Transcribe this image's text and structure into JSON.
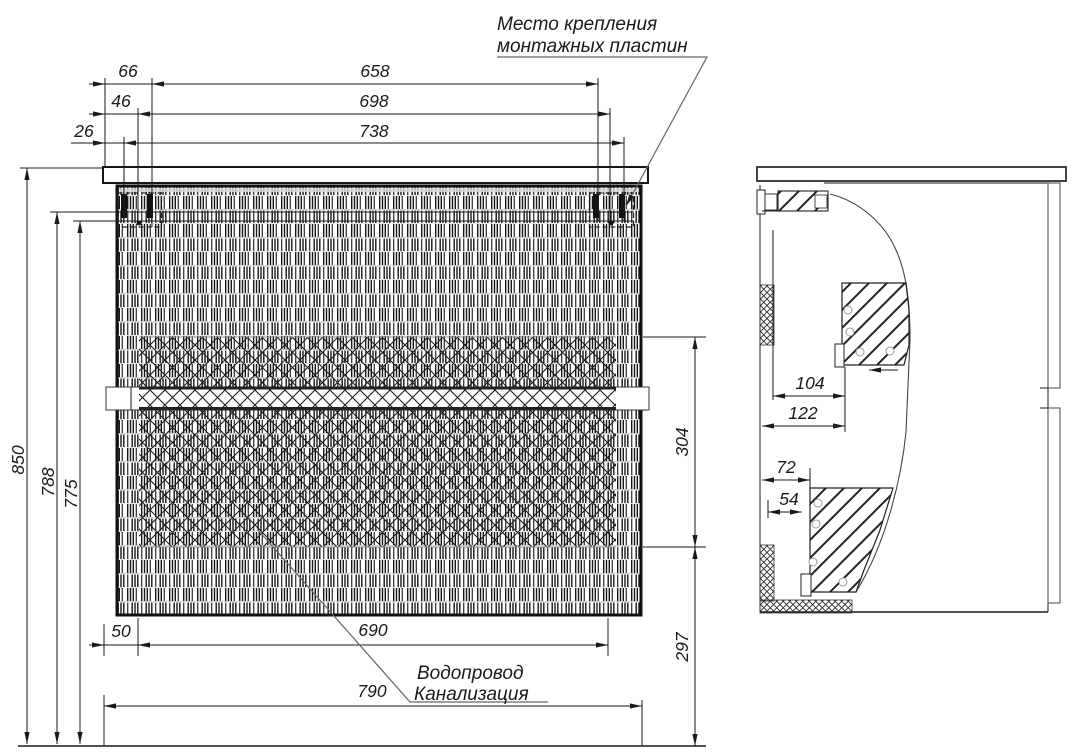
{
  "labels": {
    "mounting_plates_line1": "Место крепления",
    "mounting_plates_line2": "монтажных пластин",
    "plumbing_line1": "Водопровод",
    "plumbing_line2": "Канализация"
  },
  "dims": {
    "front_top_small_1": "66",
    "front_top_small_2": "46",
    "front_top_small_3": "26",
    "front_top_wide_1": "658",
    "front_top_wide_2": "698",
    "front_top_wide_3": "738",
    "front_left_overall": "850",
    "front_left_mid": "788",
    "front_left_inner": "775",
    "front_right_upper": "304",
    "front_right_lower": "297",
    "front_bottom_left": "50",
    "front_bottom_mid": "690",
    "front_bottom_full": "790",
    "side_plate_upper_depth": "104",
    "side_plate_upper_full": "122",
    "side_plate_lower_full": "72",
    "side_plate_lower_depth": "54"
  },
  "colors": {
    "line": "#1a1a1a",
    "leader": "#555555",
    "background": "#ffffff"
  }
}
